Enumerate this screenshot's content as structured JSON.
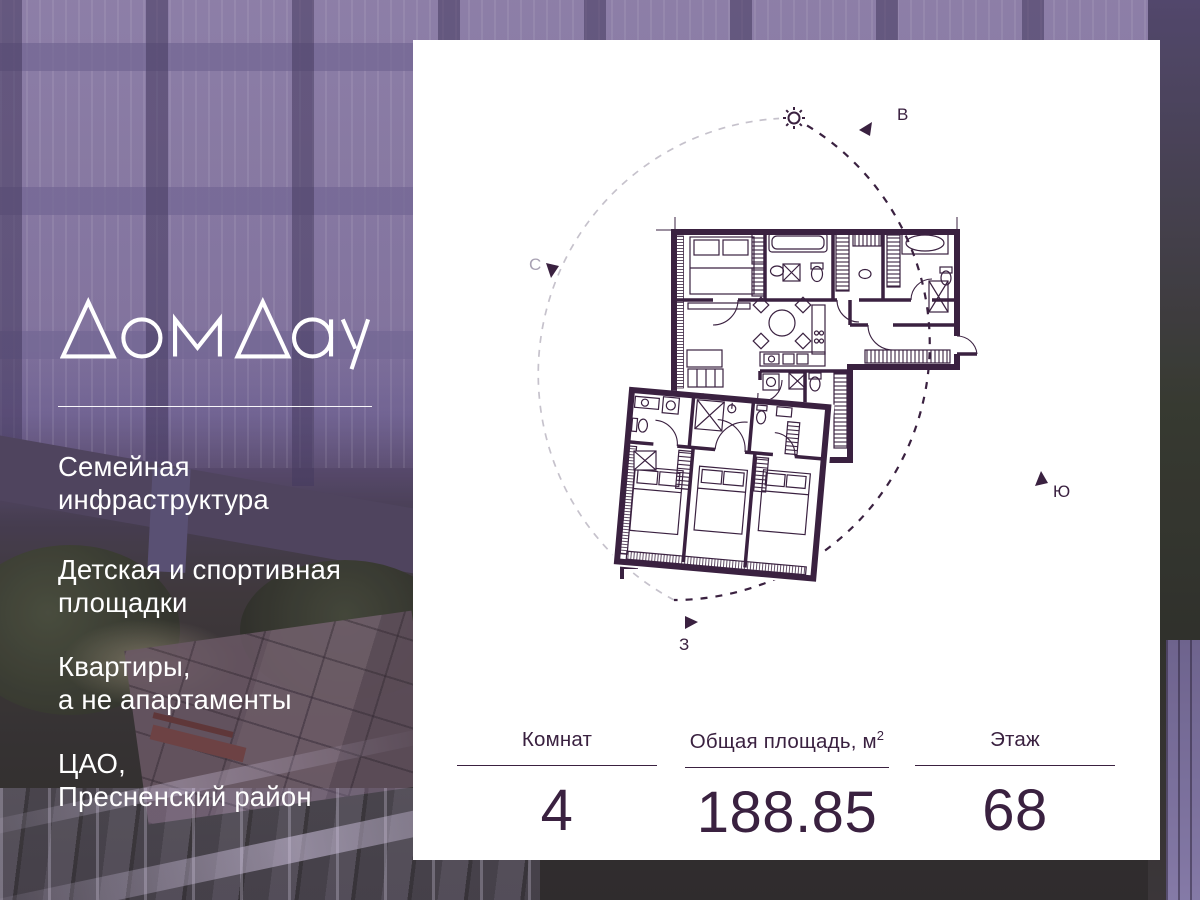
{
  "brand": {
    "logo_text": "ДомДау"
  },
  "left_panel": {
    "items": [
      {
        "line1": "Семейная",
        "line2": "инфраструктура"
      },
      {
        "line1": "Детская и спортивная",
        "line2": "площадки"
      },
      {
        "line1": "Квартиры,",
        "line2": "а не апартаменты"
      },
      {
        "line1": "ЦАО,",
        "line2": "Пресненский район"
      }
    ]
  },
  "plan": {
    "compass": {
      "north": "С",
      "east": "В",
      "south": "Ю",
      "west": "З"
    }
  },
  "stats": {
    "columns": [
      {
        "label": "Комнат",
        "value": "4"
      },
      {
        "label": "Общая площадь, м",
        "sup": "2",
        "value": "188.85"
      },
      {
        "label": "Этаж",
        "value": "68"
      }
    ]
  },
  "colors": {
    "ink": "#3a2140",
    "circle_gray": "#c6c2cc",
    "card": "#ffffff"
  }
}
